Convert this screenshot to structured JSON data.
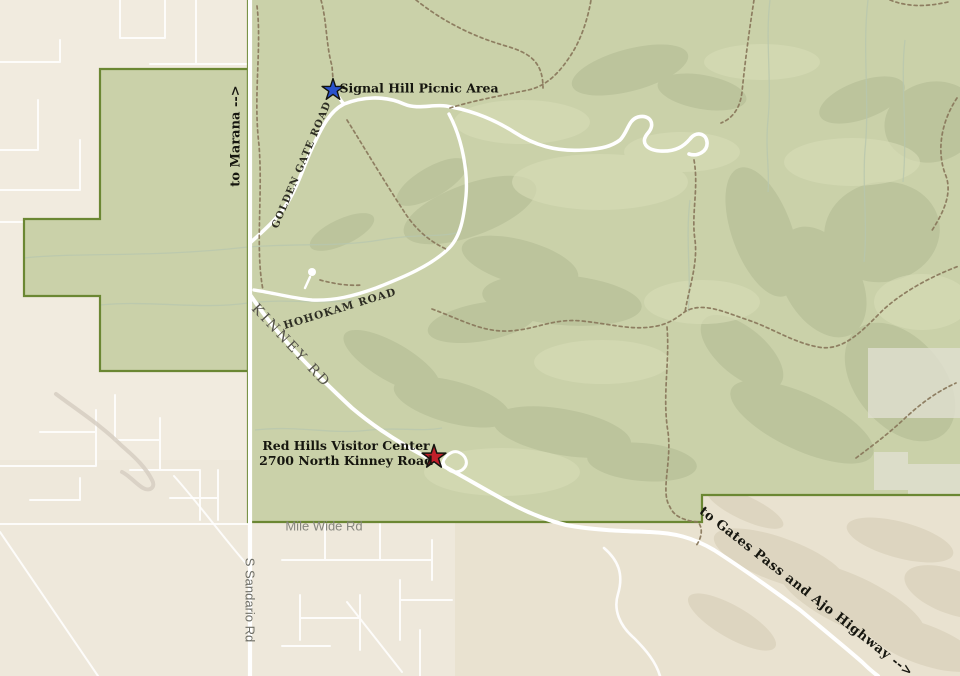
{
  "labels": {
    "signal_hill": "Signal Hill Picnic Area",
    "visitor_center_line1": "Red Hills Visitor Center",
    "visitor_center_line2": "2700 North Kinney Road",
    "to_marana": "to Marana -->",
    "to_gates_pass": "to Gates Pass and Ajo Highway -->",
    "golden_gate_road": "GOLDEN GATE ROAD",
    "hohokam_road": "HOHOKAM ROAD",
    "kinney_rd": "KINNEY RD",
    "mile_wide_rd": "Mile Wide Rd",
    "sandario_rd": "S Sandario Rd"
  },
  "markers": {
    "signal_hill_star": {
      "shape": "star",
      "x": 333,
      "y": 90,
      "color": "#2a52cc"
    },
    "visitor_center_star": {
      "shape": "star",
      "x": 434,
      "y": 457,
      "color": "#c11f2a"
    }
  },
  "colors": {
    "park_fill": "#cad1a9",
    "park_border": "#6b8733",
    "street_bg": "#f1ebdf",
    "desert_bg": "#e9e2d0",
    "road_white": "#ffffff",
    "trail_brown": "#8a795d",
    "hill_shade": "#b2bb95",
    "hill_light": "#d7dcb8",
    "desert_hill": "#d8cfb8",
    "wash_green": "#b8c7ae"
  }
}
